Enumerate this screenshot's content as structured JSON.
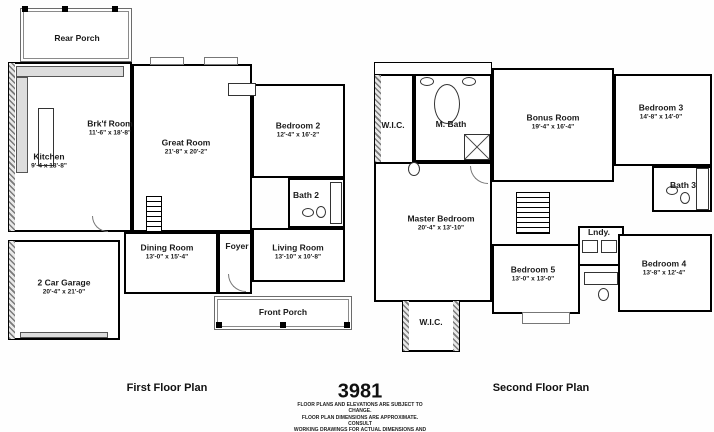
{
  "meta": {
    "plan_number": "3981",
    "disclaimer_lines": [
      "FLOOR PLANS AND ELEVATIONS ARE SUBJECT TO CHANGE.",
      "FLOOR PLAN DIMENSIONS ARE APPROXIMATE. CONSULT",
      "WORKING DRAWINGS FOR ACTUAL DIMENSIONS AND",
      "INFORMATION. ELEVATIONS/RENDERINGS ARE ARTISTS",
      "CONCEPTION."
    ]
  },
  "first_floor": {
    "caption": "First Floor Plan",
    "rooms": [
      {
        "name": "Rear Porch",
        "dims": ""
      },
      {
        "name": "Kitchen",
        "dims": "9'-4 x 18'-8\""
      },
      {
        "name": "Brk'f Room",
        "dims": "11'-6\" x 18'-8\""
      },
      {
        "name": "Great Room",
        "dims": "21'-8\" x 20'-2\""
      },
      {
        "name": "Bedroom 2",
        "dims": "12'-4\" x 16'-2\""
      },
      {
        "name": "Bath 2",
        "dims": ""
      },
      {
        "name": "Dining Room",
        "dims": "13'-0\" x 15'-4\""
      },
      {
        "name": "Foyer",
        "dims": ""
      },
      {
        "name": "Living Room",
        "dims": "13'-10\" x 10'-8\""
      },
      {
        "name": "2 Car Garage",
        "dims": "20'-4\" x 21'-0\""
      },
      {
        "name": "Front Porch",
        "dims": ""
      }
    ]
  },
  "second_floor": {
    "caption": "Second Floor Plan",
    "rooms": [
      {
        "name": "W.I.C.",
        "dims": ""
      },
      {
        "name": "M. Bath",
        "dims": ""
      },
      {
        "name": "Bonus Room",
        "dims": "19'-4\" x 16'-4\""
      },
      {
        "name": "Bedroom 3",
        "dims": "14'-8\" x 14'-0\""
      },
      {
        "name": "Master Bedroom",
        "dims": "20'-4\" x 13'-10\""
      },
      {
        "name": "Bath 3",
        "dims": ""
      },
      {
        "name": "Lndy.",
        "dims": ""
      },
      {
        "name": "Bedroom 5",
        "dims": "13'-0\" x 13'-0\""
      },
      {
        "name": "Bedroom 4",
        "dims": "13'-8\" x 12'-4\""
      },
      {
        "name": "W.I.C.",
        "dims": ""
      }
    ]
  }
}
